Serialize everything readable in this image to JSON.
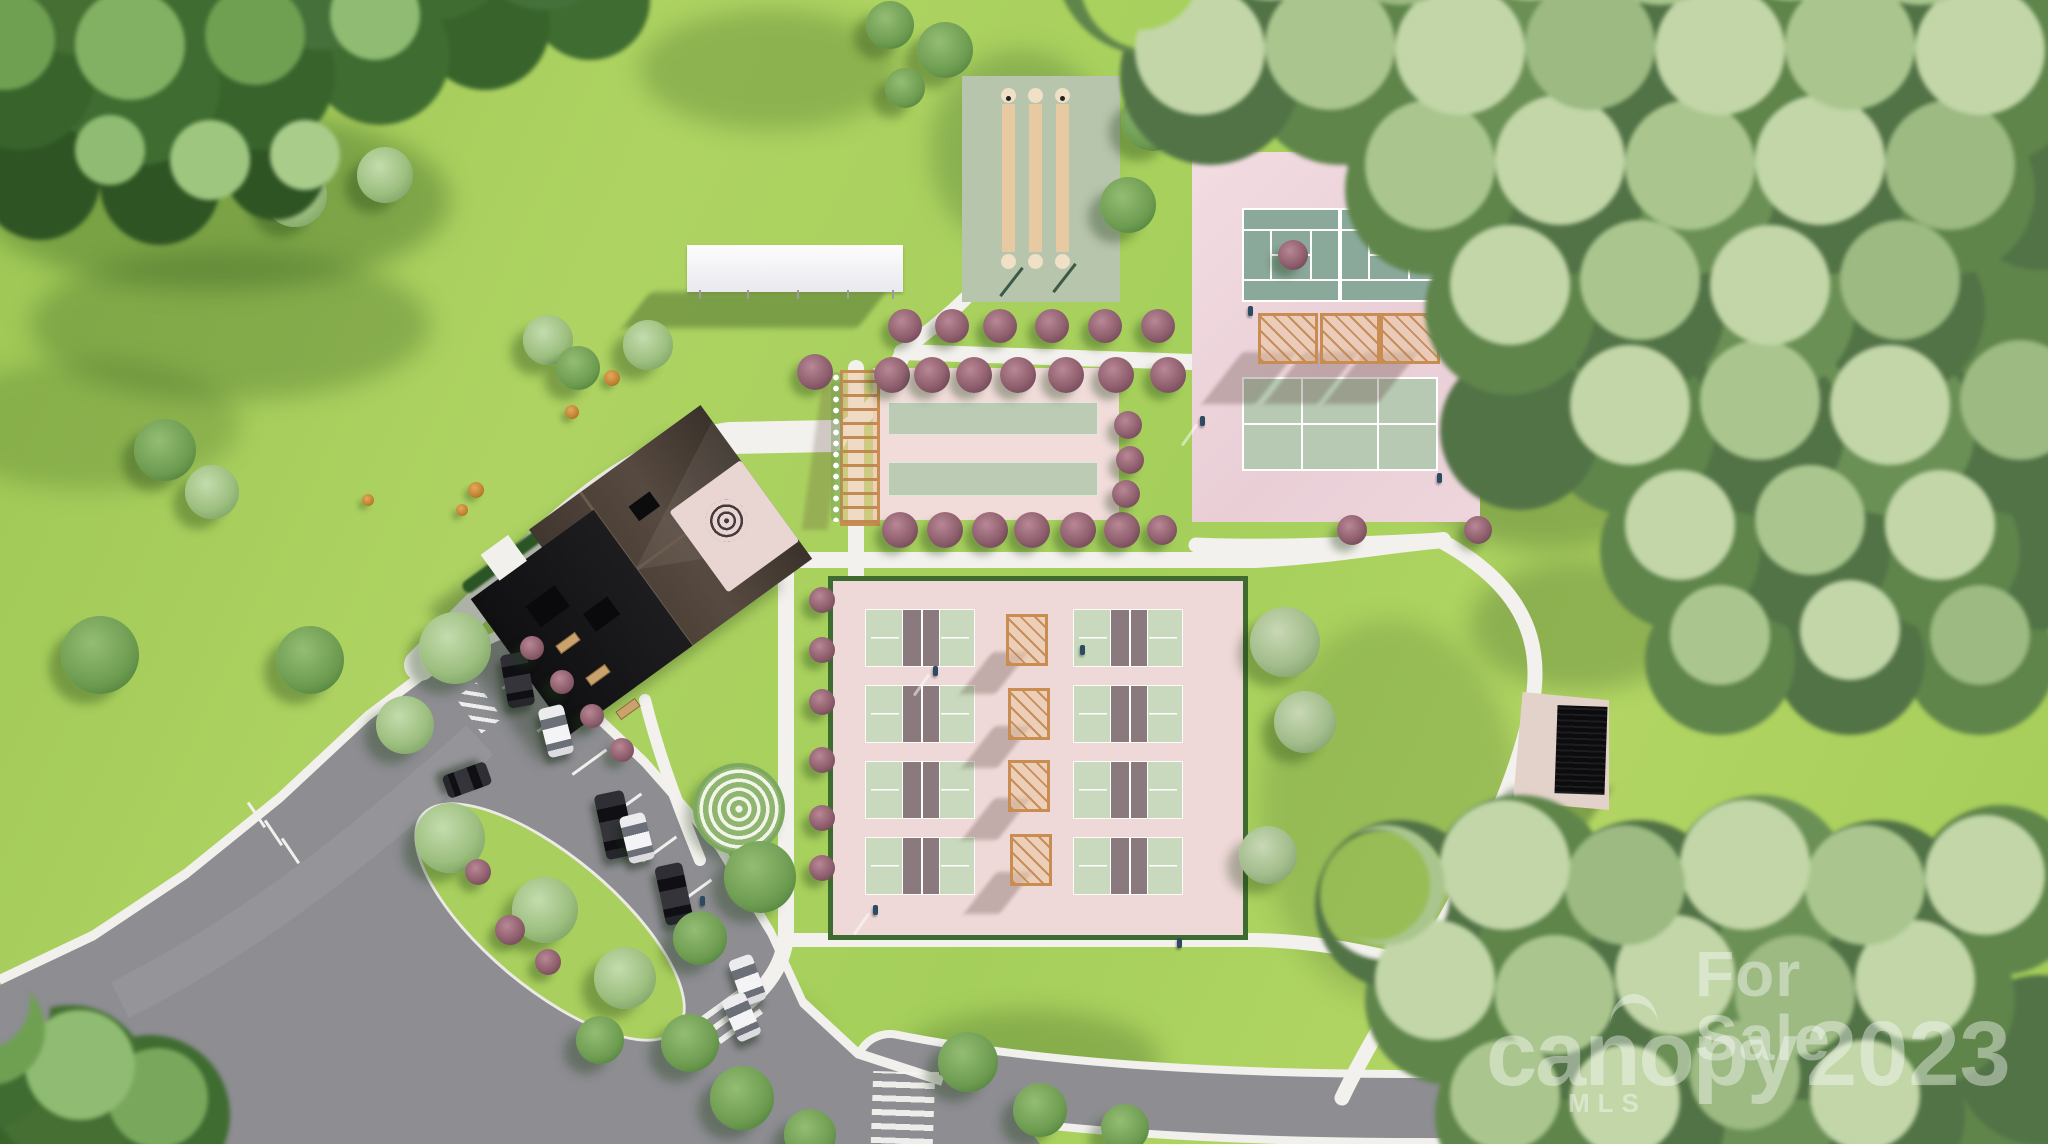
{
  "watermark": {
    "line1": "For Sale",
    "brand": "canopy",
    "year": "2023",
    "mls": "MLS"
  },
  "scene": {
    "description": "Aerial 3D architectural rendering of a community amenity campus surrounded by forest",
    "palette": {
      "lawn_green": "#a8cf5b",
      "forest_green": "#5d8a45",
      "pale_forest_green": "#a3bd8c",
      "pad_pink": "#eed7da",
      "tennis_court_teal": "#8ba99b",
      "practice_court_sage": "#b7c9b2",
      "pickleball_green": "#c8d9bd",
      "pickleball_kitchen_mauve": "#8a7a7e",
      "bocce_lane_sage": "#bccbb4",
      "shuffleboard_pad": "#b8c5ad",
      "shuffleboard_lane_tan": "#e7c9a2",
      "asphalt_gray": "#8d8d92",
      "walkway_white": "#f3f1ed",
      "clubhouse_roof_black": "#161619",
      "clubhouse_roof_brown": "#4a3f37",
      "pergola_wood_tan": "#c98d52",
      "ornamental_tree_purple": "#8f5f6e",
      "watermark_white": "rgba(255,255,255,0.40)"
    },
    "features": {
      "clubhouse": 1,
      "tennis_courts": 2,
      "practice_courts": 2,
      "pickleball_courts": 8,
      "bocce_lanes": 2,
      "shuffleboard_lanes": 3,
      "court_pergolas": 3,
      "walkway_pergolas": 4,
      "flower_trellis_walkway": 1,
      "white_shade_canopy": 1,
      "pavilion": 1,
      "spiral_garden": 1,
      "rose_patio_mosaic": 1,
      "parked_cars": 8,
      "crosswalks": 3,
      "benches": 3
    }
  }
}
